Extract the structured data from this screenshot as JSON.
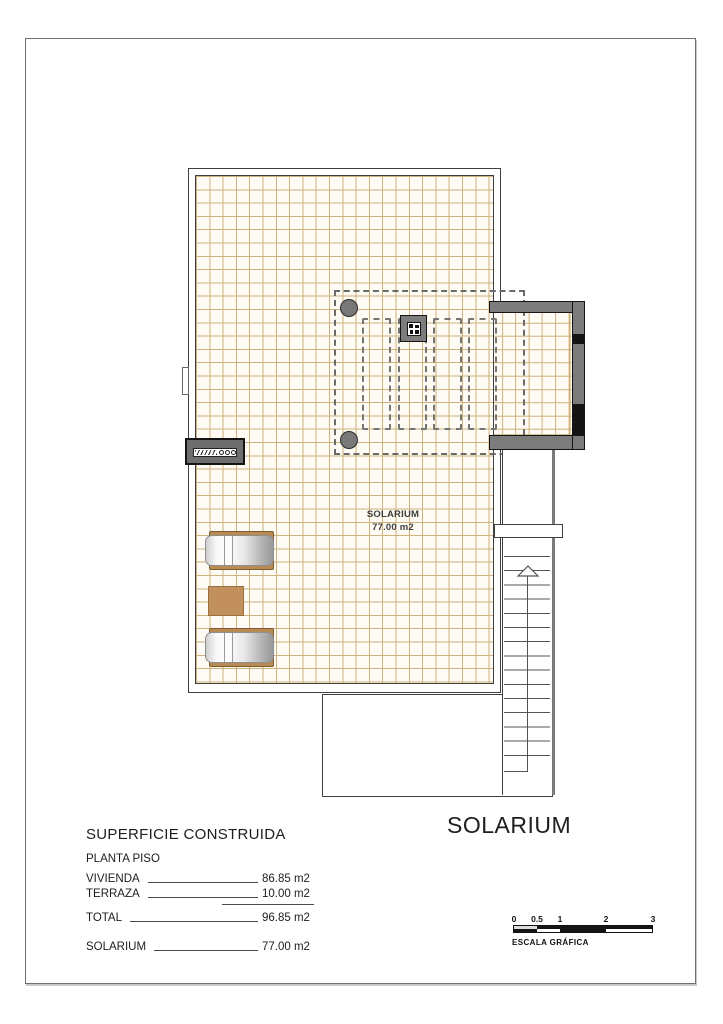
{
  "drawing": {
    "title": "SOLARIUM",
    "room_label_line1": "SOLARIUM",
    "room_label_line2": "77.00 m2"
  },
  "area_table": {
    "heading": "SUPERFICIE CONSTRUIDA",
    "subheading": "PLANTA PISO",
    "rows": [
      {
        "label": "VIVIENDA",
        "value": "86.85 m2"
      },
      {
        "label": "TERRAZA",
        "value": "10.00 m2"
      },
      {
        "label": "TOTAL",
        "value": "96.85 m2"
      },
      {
        "label": "SOLARIUM",
        "value": "77.00 m2"
      }
    ]
  },
  "scale_bar": {
    "ticks": [
      "0",
      "0.5",
      "1",
      "2",
      "3"
    ],
    "caption": "ESCALA GRÁFICA"
  },
  "colors": {
    "grid_line": "#cfb27c",
    "plan_fill": "#fdfbf3",
    "wall_gray": "#7c7c7c",
    "outline": "#3f3f3f",
    "furniture_tan": "#c2905c",
    "underlay_tan": "#b98a52"
  }
}
